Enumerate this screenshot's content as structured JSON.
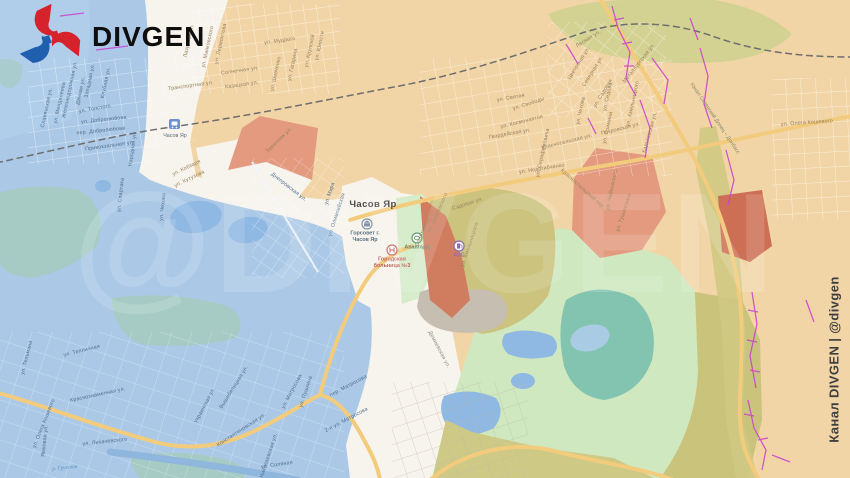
{
  "branding": {
    "logo_text": "DIVGEN",
    "watermark_text": "@DIVGEN",
    "channel_caption": "Канал DIVGEN | @divgen"
  },
  "map": {
    "city_label": "Часов Яр",
    "station_label": "Часов Яр",
    "river_label": "р. Грузская",
    "canal_label": "Канал Северский Донец – Донбасс",
    "pois": [
      {
        "id": "city-hall",
        "lines": [
          "Горсовет г.",
          "Часов Яр"
        ],
        "x": 365,
        "y": 224,
        "color": "#5b6f83"
      },
      {
        "id": "hospital",
        "lines": [
          "Городская",
          "больница №3"
        ],
        "x": 392,
        "y": 250,
        "color": "#c2605a"
      },
      {
        "id": "stadium",
        "lines": [
          "Авангард"
        ],
        "x": 417,
        "y": 238,
        "color": "#6d8a70"
      },
      {
        "id": "fuel",
        "lines": [
          "АЗС"
        ],
        "x": 459,
        "y": 246,
        "color": "#8d6cae"
      }
    ],
    "street_labels": [
      {
        "t": "Славянская ул.",
        "x": 48,
        "y": 108,
        "r": -78,
        "z": "b"
      },
      {
        "t": "ул. Менделеева",
        "x": 61,
        "y": 103,
        "r": -78,
        "z": "b"
      },
      {
        "t": "Железнодорожная ул.",
        "x": 71,
        "y": 90,
        "r": -78,
        "z": "b"
      },
      {
        "t": "Дачная ул.",
        "x": 82,
        "y": 91,
        "r": -78,
        "z": "b"
      },
      {
        "t": "Западная ул.",
        "x": 91,
        "y": 81,
        "r": -78,
        "z": "b"
      },
      {
        "t": "Клубная ул.",
        "x": 107,
        "y": 83,
        "r": -78,
        "z": "b"
      },
      {
        "t": "ул. Толстого",
        "x": 95,
        "y": 110,
        "r": -10,
        "z": "b"
      },
      {
        "t": "ул. Добролюбова",
        "x": 104,
        "y": 121,
        "r": -6,
        "z": "b"
      },
      {
        "t": "пер. Добролюбова",
        "x": 101,
        "y": 132,
        "r": -6,
        "z": "b"
      },
      {
        "t": "Привокзальная ул.",
        "x": 110,
        "y": 147,
        "r": -8,
        "z": "b"
      },
      {
        "t": "Народная ул.",
        "x": 134,
        "y": 149,
        "r": -82,
        "z": "b"
      },
      {
        "t": "ул. Спартака",
        "x": 122,
        "y": 195,
        "r": -84,
        "z": "b"
      },
      {
        "t": "ул. Чехова",
        "x": 164,
        "y": 207,
        "r": -84,
        "z": "b"
      },
      {
        "t": "ул. Кобзаря",
        "x": 187,
        "y": 169,
        "r": -26,
        "z": "p"
      },
      {
        "t": "ул. Кутузова",
        "x": 190,
        "y": 180,
        "r": -26,
        "z": "p"
      },
      {
        "t": "ул. Мира",
        "x": 331,
        "y": 194,
        "r": -72,
        "z": "b"
      },
      {
        "t": "ул. Олимпийская",
        "x": 338,
        "y": 215,
        "r": -72,
        "z": "b"
      },
      {
        "t": "Днепровская ул.",
        "x": 288,
        "y": 188,
        "r": 38,
        "z": "b"
      },
      {
        "t": "ул. Тельмана",
        "x": 28,
        "y": 358,
        "r": -76,
        "z": "b"
      },
      {
        "t": "ул. Тепличная",
        "x": 82,
        "y": 352,
        "r": -14,
        "z": "b"
      },
      {
        "t": "Краснознаменная ул.",
        "x": 98,
        "y": 396,
        "r": -12,
        "z": "b"
      },
      {
        "t": "ул. Олега Кошевого",
        "x": 45,
        "y": 424,
        "r": -68,
        "z": "b"
      },
      {
        "t": "ул. Лихачёвского",
        "x": 105,
        "y": 443,
        "r": -6,
        "z": "b"
      },
      {
        "t": "Ямковая ул.",
        "x": 46,
        "y": 441,
        "r": -84,
        "z": "b"
      },
      {
        "t": "Константиновская ул.",
        "x": 242,
        "y": 431,
        "r": -33,
        "z": "b"
      },
      {
        "t": "Украинская ул.",
        "x": 206,
        "y": 406,
        "r": -62,
        "z": "b"
      },
      {
        "t": "Вышебелицкая ул.",
        "x": 235,
        "y": 388,
        "r": -58,
        "z": "b"
      },
      {
        "t": "ул. Матросова",
        "x": 293,
        "y": 392,
        "r": -62,
        "z": "b"
      },
      {
        "t": "пер. Матросова",
        "x": 349,
        "y": 387,
        "r": -28,
        "z": "b"
      },
      {
        "t": "2-я ул. Матросова",
        "x": 347,
        "y": 421,
        "r": -28,
        "z": "b"
      },
      {
        "t": "ул. Пушкина",
        "x": 307,
        "y": 392,
        "r": -72,
        "z": "b"
      },
      {
        "t": "ул. Соляная",
        "x": 277,
        "y": 466,
        "r": -8,
        "z": "b"
      },
      {
        "t": "Николаевская ул.",
        "x": 270,
        "y": 456,
        "r": -72,
        "z": "b"
      },
      {
        "t": "Лазурная ул.",
        "x": 190,
        "y": 41,
        "r": -78,
        "z": "p"
      },
      {
        "t": "ул. Лермонтова",
        "x": 222,
        "y": 44,
        "r": -78,
        "z": "p"
      },
      {
        "t": "ул. Маяковского",
        "x": 209,
        "y": 47,
        "r": -78,
        "z": "p"
      },
      {
        "t": "ул. Мудрого",
        "x": 280,
        "y": 42,
        "r": -8,
        "z": "p"
      },
      {
        "t": "ул. Шевченко",
        "x": 277,
        "y": 74,
        "r": -78,
        "z": "p"
      },
      {
        "t": "ул. Гагарина",
        "x": 294,
        "y": 65,
        "r": -78,
        "z": "p"
      },
      {
        "t": "ул. Крупской",
        "x": 311,
        "y": 51,
        "r": -78,
        "z": "p"
      },
      {
        "t": "ул. Юности",
        "x": 321,
        "y": 46,
        "r": -78,
        "z": "p"
      },
      {
        "t": "Солнечная ул.",
        "x": 240,
        "y": 72,
        "r": -8,
        "z": "p"
      },
      {
        "t": "Казацкая ул.",
        "x": 242,
        "y": 86,
        "r": -8,
        "z": "p"
      },
      {
        "t": "Транспортная ул.",
        "x": 191,
        "y": 87,
        "r": -8,
        "z": "p"
      },
      {
        "t": "Заречная ул.",
        "x": 280,
        "y": 141,
        "r": -44,
        "z": "p"
      },
      {
        "t": "ул. Святая",
        "x": 511,
        "y": 99,
        "r": -10,
        "z": "p"
      },
      {
        "t": "ул. Свободы",
        "x": 529,
        "y": 105,
        "r": -18,
        "z": "p"
      },
      {
        "t": "ул. Космонавтов",
        "x": 522,
        "y": 123,
        "r": -14,
        "z": "p"
      },
      {
        "t": "Гвардейская ул.",
        "x": 510,
        "y": 135,
        "r": -10,
        "z": "p"
      },
      {
        "t": "ул. Серафимовича",
        "x": 544,
        "y": 153,
        "r": -78,
        "z": "p"
      },
      {
        "t": "Красносельская ул.",
        "x": 567,
        "y": 143,
        "r": -14,
        "z": "p"
      },
      {
        "t": "ул. Недогибченко",
        "x": 542,
        "y": 170,
        "r": -9,
        "z": "p"
      },
      {
        "t": "ул. Чехова",
        "x": 582,
        "y": 111,
        "r": -78,
        "z": "p"
      },
      {
        "t": "ул. Седова",
        "x": 609,
        "y": 97,
        "r": -78,
        "z": "p"
      },
      {
        "t": "ул. Озимина",
        "x": 609,
        "y": 128,
        "r": -78,
        "z": "p"
      },
      {
        "t": "ул. Хмельницкого",
        "x": 634,
        "y": 104,
        "r": -78,
        "z": "p"
      },
      {
        "t": "Покровская ул.",
        "x": 621,
        "y": 130,
        "r": -14,
        "z": "p"
      },
      {
        "t": "Харьковская ул.",
        "x": 651,
        "y": 133,
        "r": -74,
        "z": "p"
      },
      {
        "t": "Лесная ул.",
        "x": 589,
        "y": 40,
        "r": -32,
        "z": "p"
      },
      {
        "t": "Цветочная ул.",
        "x": 580,
        "y": 64,
        "r": -58,
        "z": "p"
      },
      {
        "t": "Северная ул.",
        "x": 594,
        "y": 72,
        "r": -58,
        "z": "p"
      },
      {
        "t": "ул. Садовая",
        "x": 604,
        "y": 94,
        "r": -58,
        "z": "p"
      },
      {
        "t": "Металлургская ул.",
        "x": 640,
        "y": 64,
        "r": -52,
        "z": "p"
      },
      {
        "t": "ул. Олега Кошевого",
        "x": 807,
        "y": 124,
        "r": -4,
        "z": "p"
      },
      {
        "t": "Садовая ул.",
        "x": 468,
        "y": 205,
        "r": -18,
        "z": "p"
      },
      {
        "t": "ул. Дубравского",
        "x": 439,
        "y": 213,
        "r": -66,
        "z": "p"
      },
      {
        "t": "Спортивная ул.",
        "x": 426,
        "y": 228,
        "r": -66,
        "z": "p"
      },
      {
        "t": "ул. Хмельницкого",
        "x": 471,
        "y": 245,
        "r": -72,
        "z": "p"
      },
      {
        "t": "ул. Чайковского",
        "x": 613,
        "y": 190,
        "r": -78,
        "z": "p"
      },
      {
        "t": "ул. Тушинского",
        "x": 625,
        "y": 213,
        "r": -72,
        "z": "p"
      },
      {
        "t": "Красностальский пер.",
        "x": 582,
        "y": 190,
        "r": 42,
        "z": "p"
      },
      {
        "t": "Демиевская ул.",
        "x": 438,
        "y": 350,
        "r": 62,
        "z": "w"
      }
    ]
  },
  "colors": {
    "ua_zone": "#abc9e7",
    "ru_zone": "#f2d5a7",
    "neutral_zone": "#f7f4ed",
    "assault_light": "#e39a7f",
    "assault_dark": "#d07c5f",
    "assault_deep": "#cd6f55",
    "forest_olive": "#cbc37e",
    "forest_olive_light": "#d4d293",
    "green_zone": "#cfe8bf",
    "park_green": "#d7eccb",
    "lake_teal": "#83c4b0",
    "pond_blue": "#8fb9e3",
    "industrial_grey": "#c6beb0",
    "road_yellow": "#f2cb7d",
    "railway_grey": "#6e6e6e",
    "trench_magenta": "#c940cf",
    "logo_red": "#d6222a",
    "logo_blue": "#1f5fae"
  }
}
